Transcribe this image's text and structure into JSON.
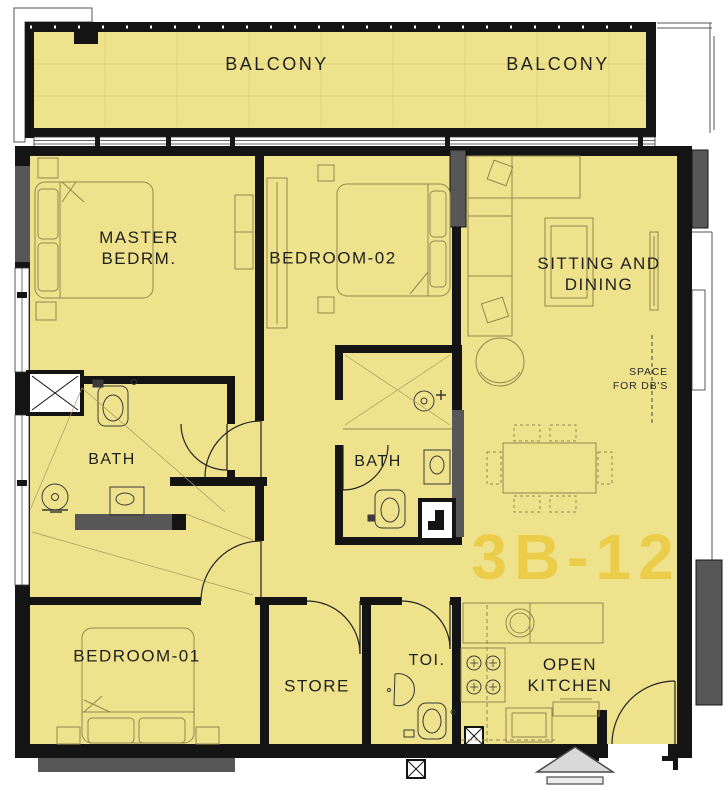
{
  "unit": {
    "number": "3B-12"
  },
  "colors": {
    "floor": "#efe28c",
    "wall": "#141414",
    "column_gray": "#575757",
    "furniture_line": "#93864f",
    "unit_number": "#ebcd49"
  },
  "rooms": {
    "balcony_left": "BALCONY",
    "balcony_right": "BALCONY",
    "master_bedroom": "MASTER BEDRM.",
    "bedroom_02": "BEDROOM-02",
    "sitting_dining": "SITTING AND DINING",
    "bath_master": "BATH",
    "bath_2": "BATH",
    "bedroom_01": "BEDROOM-01",
    "store": "STORE",
    "toilet": "TOI.",
    "open_kitchen": "OPEN KITCHEN",
    "db_space": "SPACE\nFOR DB'S"
  }
}
